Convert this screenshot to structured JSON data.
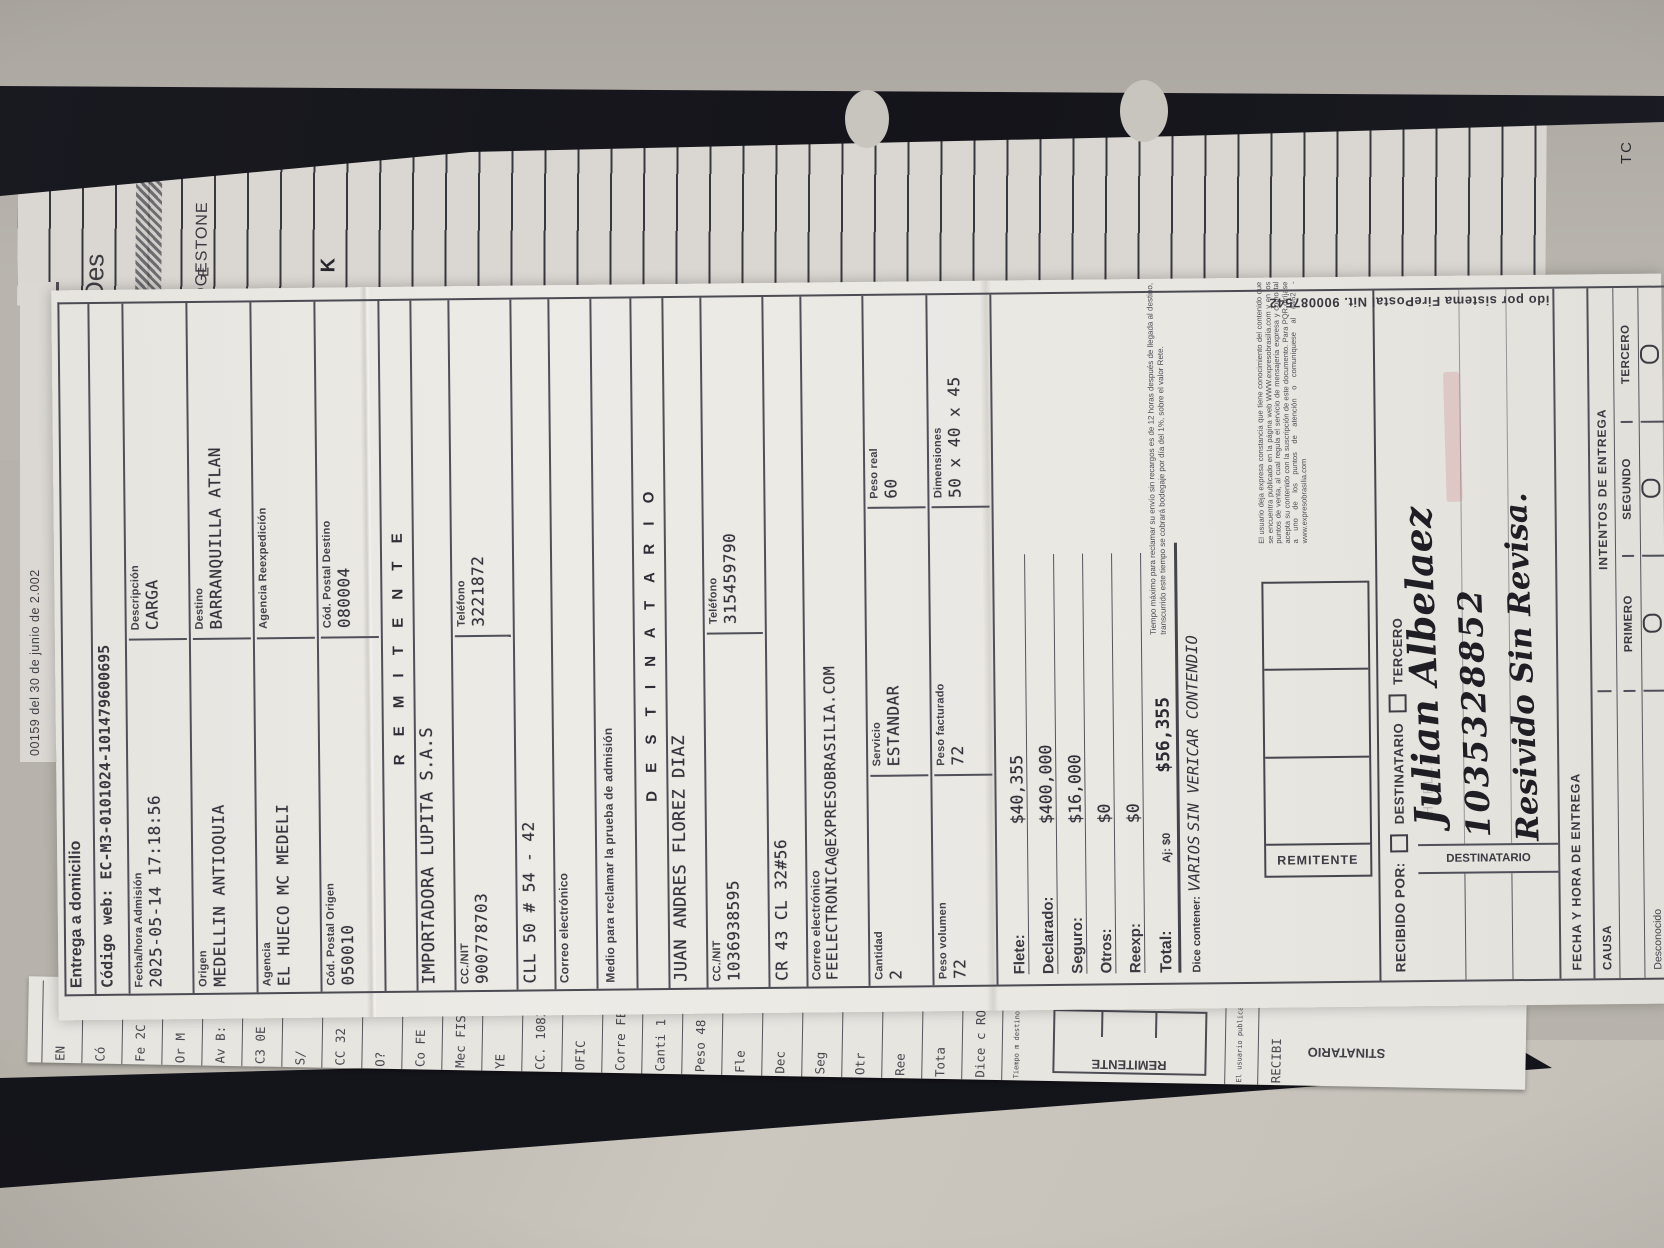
{
  "photo": {
    "colors": {
      "wall": "#b7b3ac",
      "table_light": "#cbc7bf",
      "folder_black": "#14141b",
      "paper": "#eae8e3",
      "ledger_paper": "#dad7d2",
      "ink": "#34333b",
      "pink_stamp": "#cd828c"
    }
  },
  "background_sheet": {
    "brand_fragment": "DGESTONE",
    "brand_extra": "E",
    "des_fragment": "Des",
    "k_fragment": "K",
    "corner_fragment": "TC",
    "date_line": "00159 del 30 de junio de 2.002"
  },
  "receipt": {
    "title": "Entrega a domicilio",
    "codigo_web": "Código web:  EC-M3-0101024-101479600695",
    "admission": {
      "label": "Fecha/hora  Admisión",
      "value": "2025-05-14 17:18:56"
    },
    "descripcion": {
      "label": "Descripción",
      "value": "CARGA"
    },
    "origen": {
      "label": "Origen",
      "value": "MEDELLIN ANTIOQUIA"
    },
    "destino": {
      "label": "Destino",
      "value": "BARRANQUILLA ATLAN"
    },
    "agencia": {
      "label": "Agencia",
      "value": "EL HUECO MC MEDELI"
    },
    "agencia_reexp": {
      "label": "Agencia Reexpedición",
      "value": ""
    },
    "cod_postal_origen": {
      "label": "Cód. Postal Origen",
      "value": "050010"
    },
    "cod_postal_destino": {
      "label": "Cód. Postal Destino",
      "value": "080004"
    },
    "remitente": {
      "header": "R E M I T E N T E",
      "nombre": "IMPORTADORA LUPITA S.A.S",
      "ccnit_label": "CC./NIT",
      "ccnit": "900778703",
      "tel_label": "Teléfono",
      "tel": "3221872",
      "direccion": "CLL 50 # 54 - 42",
      "correo_label": "Correo electrónico",
      "correo": "",
      "medio_label": "Medio para reclamar la prueba de admisión"
    },
    "destinatario": {
      "header": "D E S T I N A T A R I O",
      "nombre": "JUAN ANDRES FLOREZ DIAZ",
      "ccnit_label": "CC./NIT",
      "ccnit": "1036938595",
      "tel_label": "Teléfono",
      "tel": "315459790",
      "direccion": "CR 43 CL 32#56",
      "correo_label": "Correo electrónico",
      "correo": "FEELECTRONICA@EXPRESOBRASILIA.COM"
    },
    "medidas": {
      "cantidad_label": "Cantidad",
      "cantidad": "2",
      "servicio_label": "Servicio",
      "servicio": "ESTANDAR",
      "peso_real_label": "Peso real",
      "peso_real": "60",
      "peso_vol_label": "Peso volumen",
      "peso_vol": "72",
      "peso_fact_label": "Peso facturado",
      "peso_fact": "72",
      "dim_label": "Dimensiones",
      "dim": "50 x 40 x 45"
    },
    "money": [
      {
        "label": "Flete:",
        "value": "$40,355"
      },
      {
        "label": "Declarado:",
        "value": "$400,000"
      },
      {
        "label": "Seguro:",
        "value": "$16,000"
      },
      {
        "label": "Otros:",
        "value": "$0"
      },
      {
        "label": "Reexp:",
        "value": "$0"
      }
    ],
    "total": {
      "label": "Total:",
      "aj": "Aj: $0",
      "value": "$56,355"
    },
    "dice_contener": {
      "label": "Dice contener:",
      "line1": "VARIOS",
      "line2": "SIN VERICAR CONTENDIO"
    },
    "fine_print_1": "Tiempo máximo para reclamar su envío sin recargos es de 12 horas después de llegada al destino, transcurrido este tiempo se cobrará bodegaje por día del 1%, sobre el valor Rete.",
    "remitente_box_label": "REMITENTE",
    "fine_print_2": "El usuario deja expresa constancia que tiene conocimiento del contenido que se encuentra publicado en la página web WWW.expresobrasilia.com y en los puntos de venta, al cual regula el servicio de mensajería expresa y como tal acepta su contenido con la suscripción de este documento. Para PQR diríjase a uno de los puntos de atención o comuníquese al #462 - www.expresobrasilia.com",
    "recibido": {
      "label": "RECIBIDO POR:",
      "opt1": "DESTINATARIO",
      "opt2": "TERCERO"
    },
    "destinatario_box_label": "DESTINATARIO",
    "faint_stamp": "HUELLA",
    "handwriting": {
      "line1": "Julian Albelaez",
      "line2": "1035328852",
      "line3": "Resivido Sin Revisa."
    },
    "fecha_entrega_label": "FECHA Y HORA DE ENTREGA",
    "intentos": {
      "header": "INTENTOS DE ENTREGA",
      "cols": [
        "PRIMERO",
        "SEGUNDO",
        "TERCERO"
      ],
      "causa_label": "CAUSA",
      "causas": [
        "Desconocido",
        "Rehusado",
        "No reside",
        "No reclamado"
      ]
    },
    "margin_text": "ido por sistema FirePostal Nit. 900087542"
  },
  "under_sheet": {
    "fragments": [
      {
        "t": "EN",
        "kind": "v"
      },
      {
        "t": "Có",
        "kind": "v"
      },
      {
        "t": "Fe  2C",
        "kind": "v"
      },
      {
        "t": "Or  M",
        "kind": "v"
      },
      {
        "t": "Av  B:",
        "kind": "v"
      },
      {
        "t": "C3  0E",
        "kind": "v"
      },
      {
        "t": "S/",
        "kind": "v"
      },
      {
        "t": "CC  32",
        "kind": "v"
      },
      {
        "t": "O?",
        "kind": "v"
      },
      {
        "t": "Co  FE",
        "kind": "v"
      },
      {
        "t": "Mec  FIS",
        "kind": "v"
      },
      {
        "t": "YE",
        "kind": "v"
      },
      {
        "t": "CC.  1082",
        "kind": "v"
      },
      {
        "t": "OFIC",
        "kind": "v"
      },
      {
        "t": "Corre  FEL",
        "kind": "v"
      },
      {
        "t": "Canti  1",
        "kind": "v"
      },
      {
        "t": "Peso  48",
        "kind": "v"
      },
      {
        "t": "Fle",
        "kind": "v"
      },
      {
        "t": "Dec",
        "kind": "v"
      },
      {
        "t": "Seg",
        "kind": "v"
      },
      {
        "t": "Otr",
        "kind": "v"
      },
      {
        "t": "Ree",
        "kind": "v"
      },
      {
        "t": "Tota",
        "kind": "v"
      },
      {
        "t": "Dice c  ROP/",
        "kind": "v"
      },
      {
        "t": "Tiempo m  destino, tr",
        "kind": "tiny"
      },
      {
        "t": "REMITENTE",
        "kind": "box"
      },
      {
        "t": "El usuario publicado regula serv de este doc www.expres",
        "kind": "tiny"
      },
      {
        "t": "RECIBI",
        "kind": "v"
      },
      {
        "t": "STINATARIO",
        "kind": "flip"
      }
    ]
  }
}
